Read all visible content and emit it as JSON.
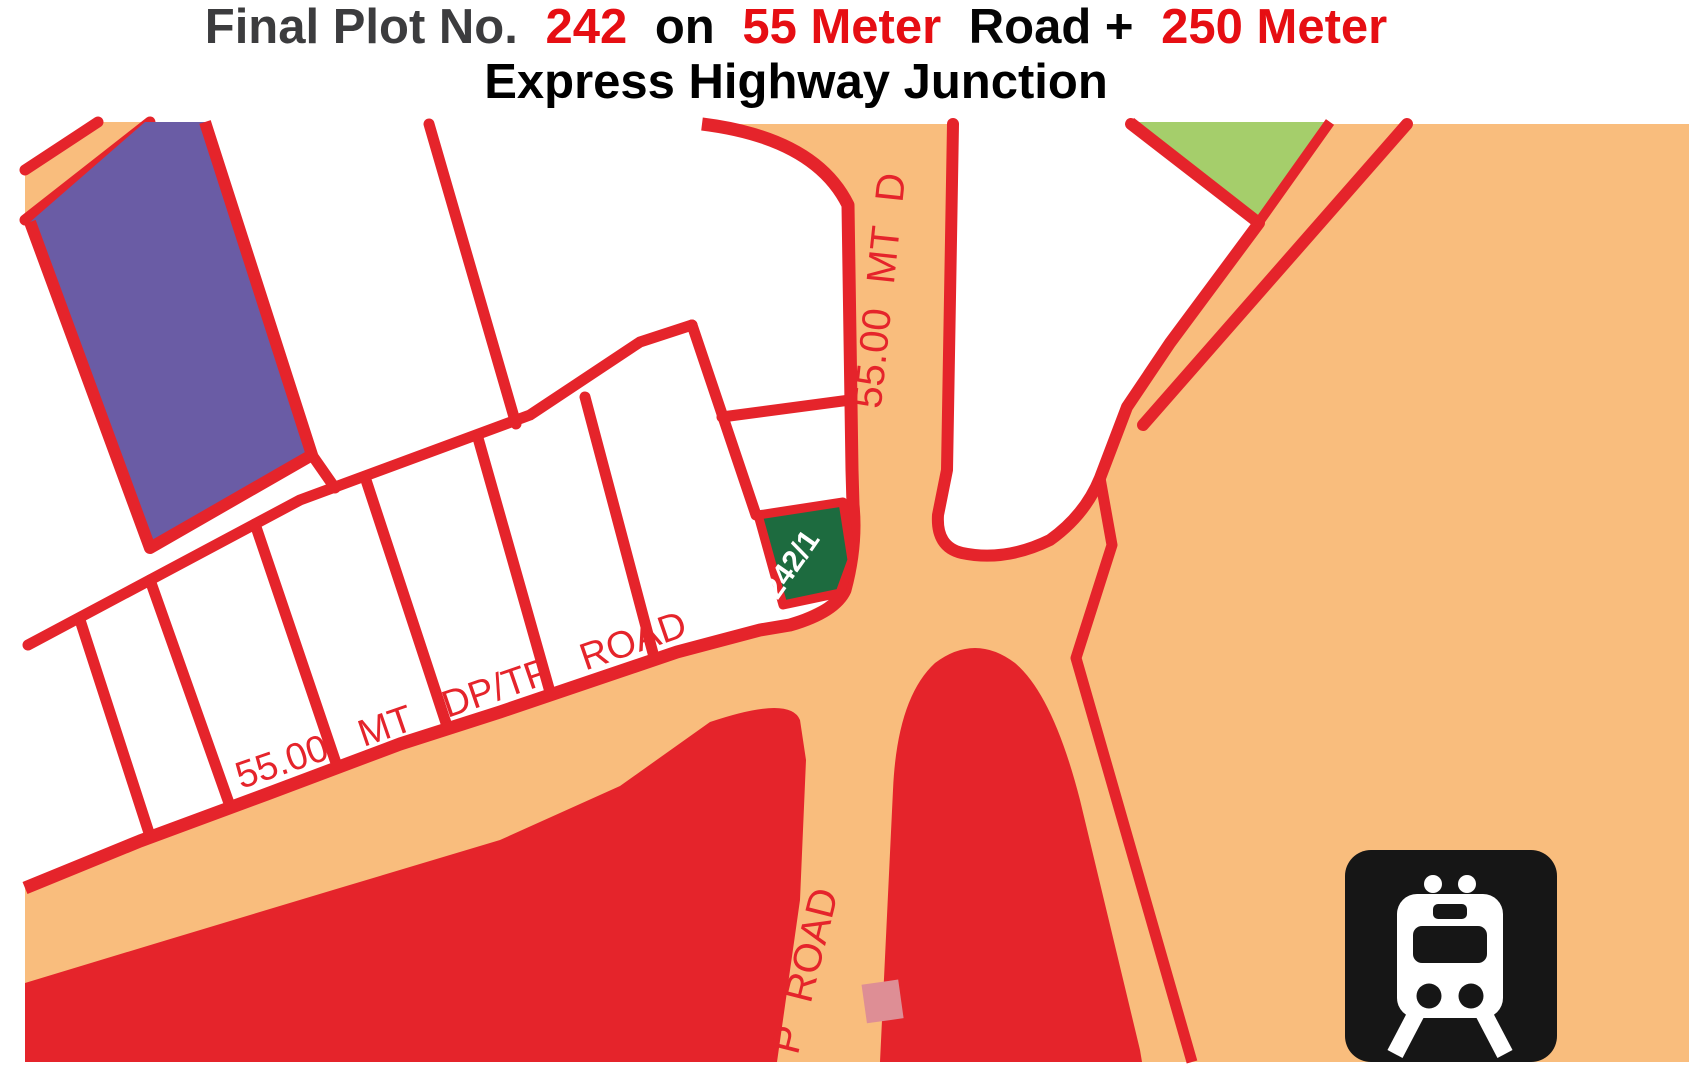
{
  "title": {
    "seg1": "Final Plot No.",
    "seg2": "242",
    "seg3": "on",
    "seg4": "55 Meter",
    "seg5": "Road +",
    "seg6": "250 Meter",
    "line2": "Express Highgway Junction",
    "line2_display": "Express Highway Junction"
  },
  "map": {
    "road_labels": {
      "vertical": "55.00 MT D",
      "diagonal": "55.00 MT DP/TP ROAD",
      "bottom": "P ROAD"
    },
    "plot_label": "242/1",
    "icons": {
      "station_icon": "train"
    },
    "colors": {
      "road_orange": "#f9bd7d",
      "boundary_red": "#e5242b",
      "plot_purple": "#6a5ca5",
      "plot_light_green": "#a5ce6b",
      "plot_dark_green": "#1d6b3f",
      "reserved_pink": "#de8e95",
      "plot_white": "#ffffff",
      "icon_black": "#161616",
      "title_red": "#e60e13",
      "title_dark": "#3c3c3e"
    }
  }
}
